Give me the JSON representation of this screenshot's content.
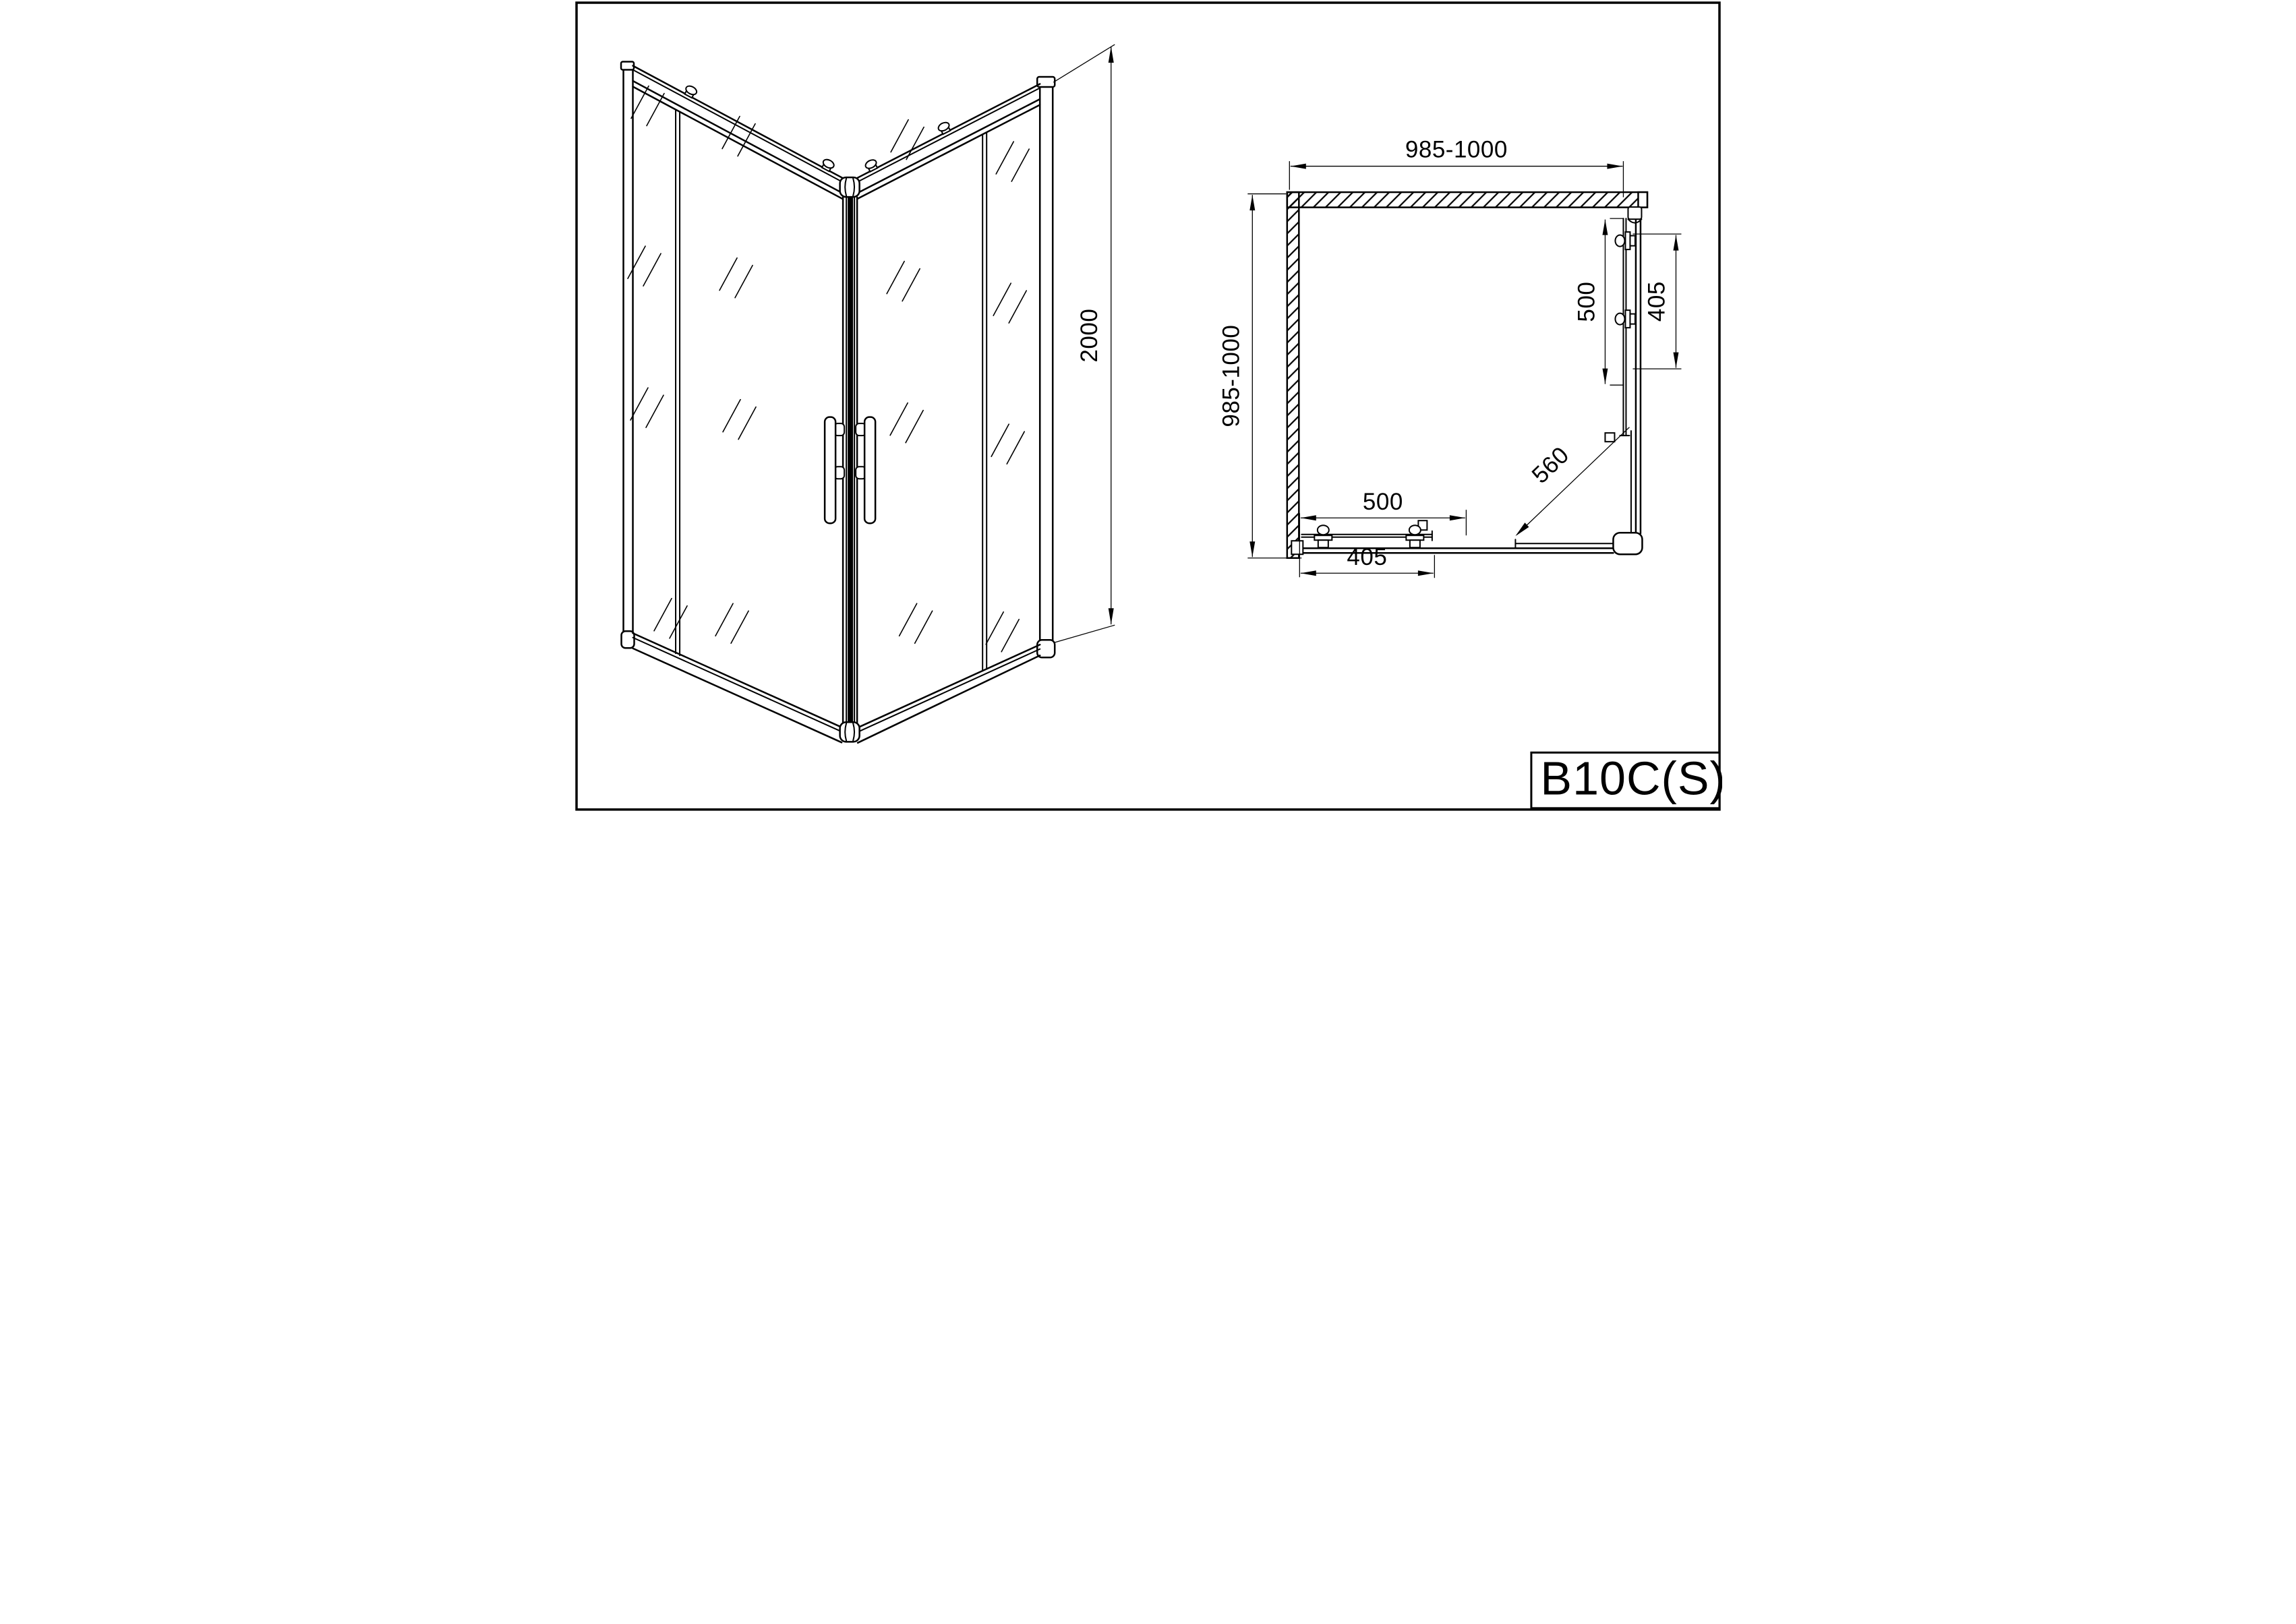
{
  "sheet": {
    "colors": {
      "line": "#000000",
      "paper": "#ffffff"
    },
    "title_block": {
      "model_code": "B10C(S)"
    },
    "perspective_view": {
      "height_mm": "2000"
    },
    "plan_view": {
      "width_mm": "985-1000",
      "depth_mm": "985-1000",
      "side_door": {
        "panel_mm": "500",
        "glass_mm": "405"
      },
      "bottom_door": {
        "panel_mm": "500",
        "glass_mm": "405"
      },
      "diagonal_entry_mm": "560"
    }
  }
}
